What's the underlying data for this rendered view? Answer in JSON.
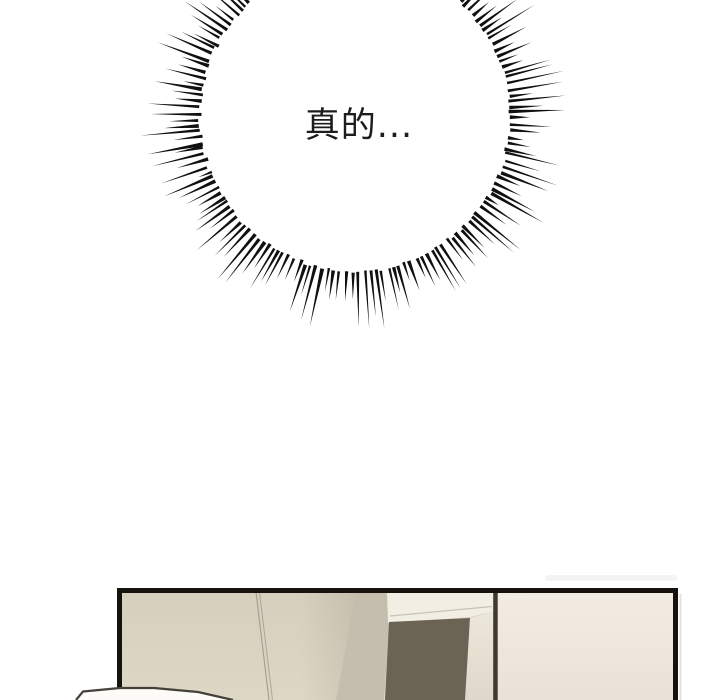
{
  "page": {
    "background": "#ffffff",
    "width": 720,
    "height": 700
  },
  "speech": {
    "text": "真的...",
    "color": "#1d1d1d"
  },
  "burst": {
    "cx": 355,
    "cy": 116,
    "inner_radius": 156,
    "count": 164,
    "min_len": 26,
    "max_len": 60,
    "short_ratio": 0.28,
    "short_scale": 0.55,
    "base_width": 3.2,
    "angle_jitter": 0.6,
    "seed": 11,
    "color": "#101010"
  },
  "panel": {
    "border_color": "#16120e",
    "colors": {
      "left_wall_top": "#d5cfbd",
      "left_wall_bottom": "#ddd7c5",
      "wall_shade": "#787364",
      "wall_line": "#9e988b",
      "pillar": "#c4beae",
      "lintel": "#f2eee3",
      "lintel_line": "#c9c3b4",
      "doorway": "#6b6455",
      "door_frame_top": "#ece7da",
      "door_frame_bottom": "#ded8ca",
      "corner_line": "#3e3a32",
      "right_wall_top": "#f2ece2",
      "right_wall_bottom": "#e9e2d8",
      "right_wall_highlight": "#f7f3ea",
      "outer_shadow": "#d9d7d2",
      "outer_haze": "#f0efec",
      "white_object_fill": "#fcfbf7",
      "white_object_edge": "#45403a"
    }
  }
}
